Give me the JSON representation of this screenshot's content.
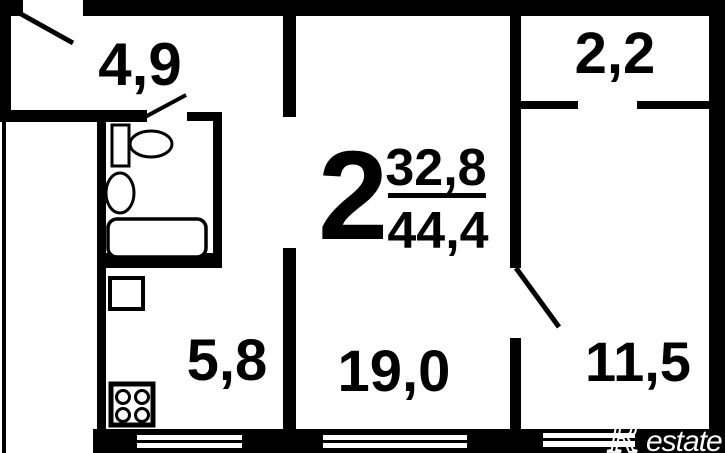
{
  "floorplan": {
    "apartment_type": "2",
    "living_area": "32,8",
    "total_area": "44,4",
    "rooms": {
      "hallway_area": "4,9",
      "balcony_area": "2,2",
      "kitchen_area": "5,8",
      "living_room_area": "19,0",
      "bedroom_area": "11,5"
    },
    "brand": {
      "logo_r": "R",
      "logo_rest": "estate"
    },
    "colors": {
      "wall": "#000000",
      "background": "#ffffff",
      "logo": "#ffffff"
    }
  }
}
